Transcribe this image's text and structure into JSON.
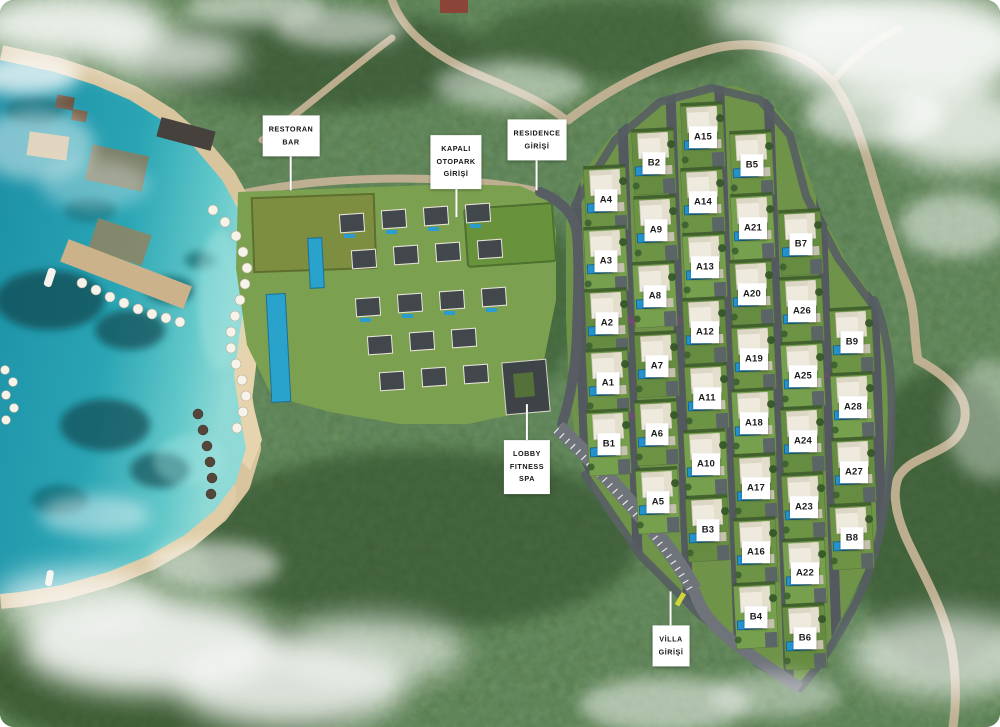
{
  "plan": {
    "callouts": [
      {
        "id": "restoran-bar",
        "lines": [
          "RESTORAN",
          "BAR"
        ],
        "x": 291,
        "y": 136,
        "pointer": "down",
        "pointer_len": 34
      },
      {
        "id": "kapali-otopark-girisi",
        "lines": [
          "KAPALI",
          "OTOPARK",
          "GİRİŞİ"
        ],
        "x": 456,
        "y": 162,
        "pointer": "down",
        "pointer_len": 28
      },
      {
        "id": "residence-girisi",
        "lines": [
          "RESIDENCE",
          "GİRİŞİ"
        ],
        "x": 537,
        "y": 140,
        "pointer": "down",
        "pointer_len": 30
      },
      {
        "id": "lobby-fitness-spa",
        "lines": [
          "LOBBY",
          "FITNESS",
          "SPA"
        ],
        "x": 527,
        "y": 467,
        "pointer": "up",
        "pointer_len": 36
      },
      {
        "id": "villa-girisi",
        "lines": [
          "VİLLA",
          "GİRİŞİ"
        ],
        "x": 671,
        "y": 646,
        "pointer": "up",
        "pointer_len": 34
      }
    ],
    "villas": [
      {
        "id": "A4",
        "x": 606,
        "y": 200
      },
      {
        "id": "A3",
        "x": 606,
        "y": 261
      },
      {
        "id": "A2",
        "x": 607,
        "y": 323
      },
      {
        "id": "A1",
        "x": 608,
        "y": 383
      },
      {
        "id": "B1",
        "x": 609,
        "y": 444
      },
      {
        "id": "B2",
        "x": 654,
        "y": 163
      },
      {
        "id": "A9",
        "x": 656,
        "y": 230
      },
      {
        "id": "A8",
        "x": 655,
        "y": 296
      },
      {
        "id": "A7",
        "x": 657,
        "y": 366
      },
      {
        "id": "A6",
        "x": 657,
        "y": 434
      },
      {
        "id": "A5",
        "x": 658,
        "y": 502
      },
      {
        "id": "A15",
        "x": 703,
        "y": 137
      },
      {
        "id": "A14",
        "x": 703,
        "y": 202
      },
      {
        "id": "A13",
        "x": 705,
        "y": 267
      },
      {
        "id": "A12",
        "x": 705,
        "y": 332
      },
      {
        "id": "A11",
        "x": 707,
        "y": 398
      },
      {
        "id": "A10",
        "x": 706,
        "y": 464
      },
      {
        "id": "B3",
        "x": 708,
        "y": 530
      },
      {
        "id": "B5",
        "x": 752,
        "y": 165
      },
      {
        "id": "A21",
        "x": 753,
        "y": 228
      },
      {
        "id": "A20",
        "x": 752,
        "y": 294
      },
      {
        "id": "A19",
        "x": 754,
        "y": 359
      },
      {
        "id": "A18",
        "x": 754,
        "y": 423
      },
      {
        "id": "A17",
        "x": 756,
        "y": 488
      },
      {
        "id": "A16",
        "x": 756,
        "y": 552
      },
      {
        "id": "B4",
        "x": 756,
        "y": 617
      },
      {
        "id": "B7",
        "x": 801,
        "y": 244
      },
      {
        "id": "A26",
        "x": 802,
        "y": 311
      },
      {
        "id": "A25",
        "x": 803,
        "y": 376
      },
      {
        "id": "A24",
        "x": 803,
        "y": 441
      },
      {
        "id": "A23",
        "x": 804,
        "y": 507
      },
      {
        "id": "A22",
        "x": 805,
        "y": 573
      },
      {
        "id": "B6",
        "x": 805,
        "y": 638
      },
      {
        "id": "B9",
        "x": 852,
        "y": 342
      },
      {
        "id": "A28",
        "x": 853,
        "y": 407
      },
      {
        "id": "A27",
        "x": 854,
        "y": 472
      },
      {
        "id": "B8",
        "x": 852,
        "y": 538
      }
    ],
    "colors": {
      "sea_deep": "#1b8fa6",
      "sea_shallow": "#8fd9d6",
      "sand": "#dcc9a2",
      "forest": "#42633a",
      "road_dirt": "#c3b294",
      "road_asphalt": "#676e74",
      "pool": "#2492cc",
      "lawn": "#6d9345",
      "building": "#efeade",
      "label_bg": "#ffffff",
      "label_text": "#1b1b1b",
      "flower_accent": "#a9309a"
    }
  }
}
